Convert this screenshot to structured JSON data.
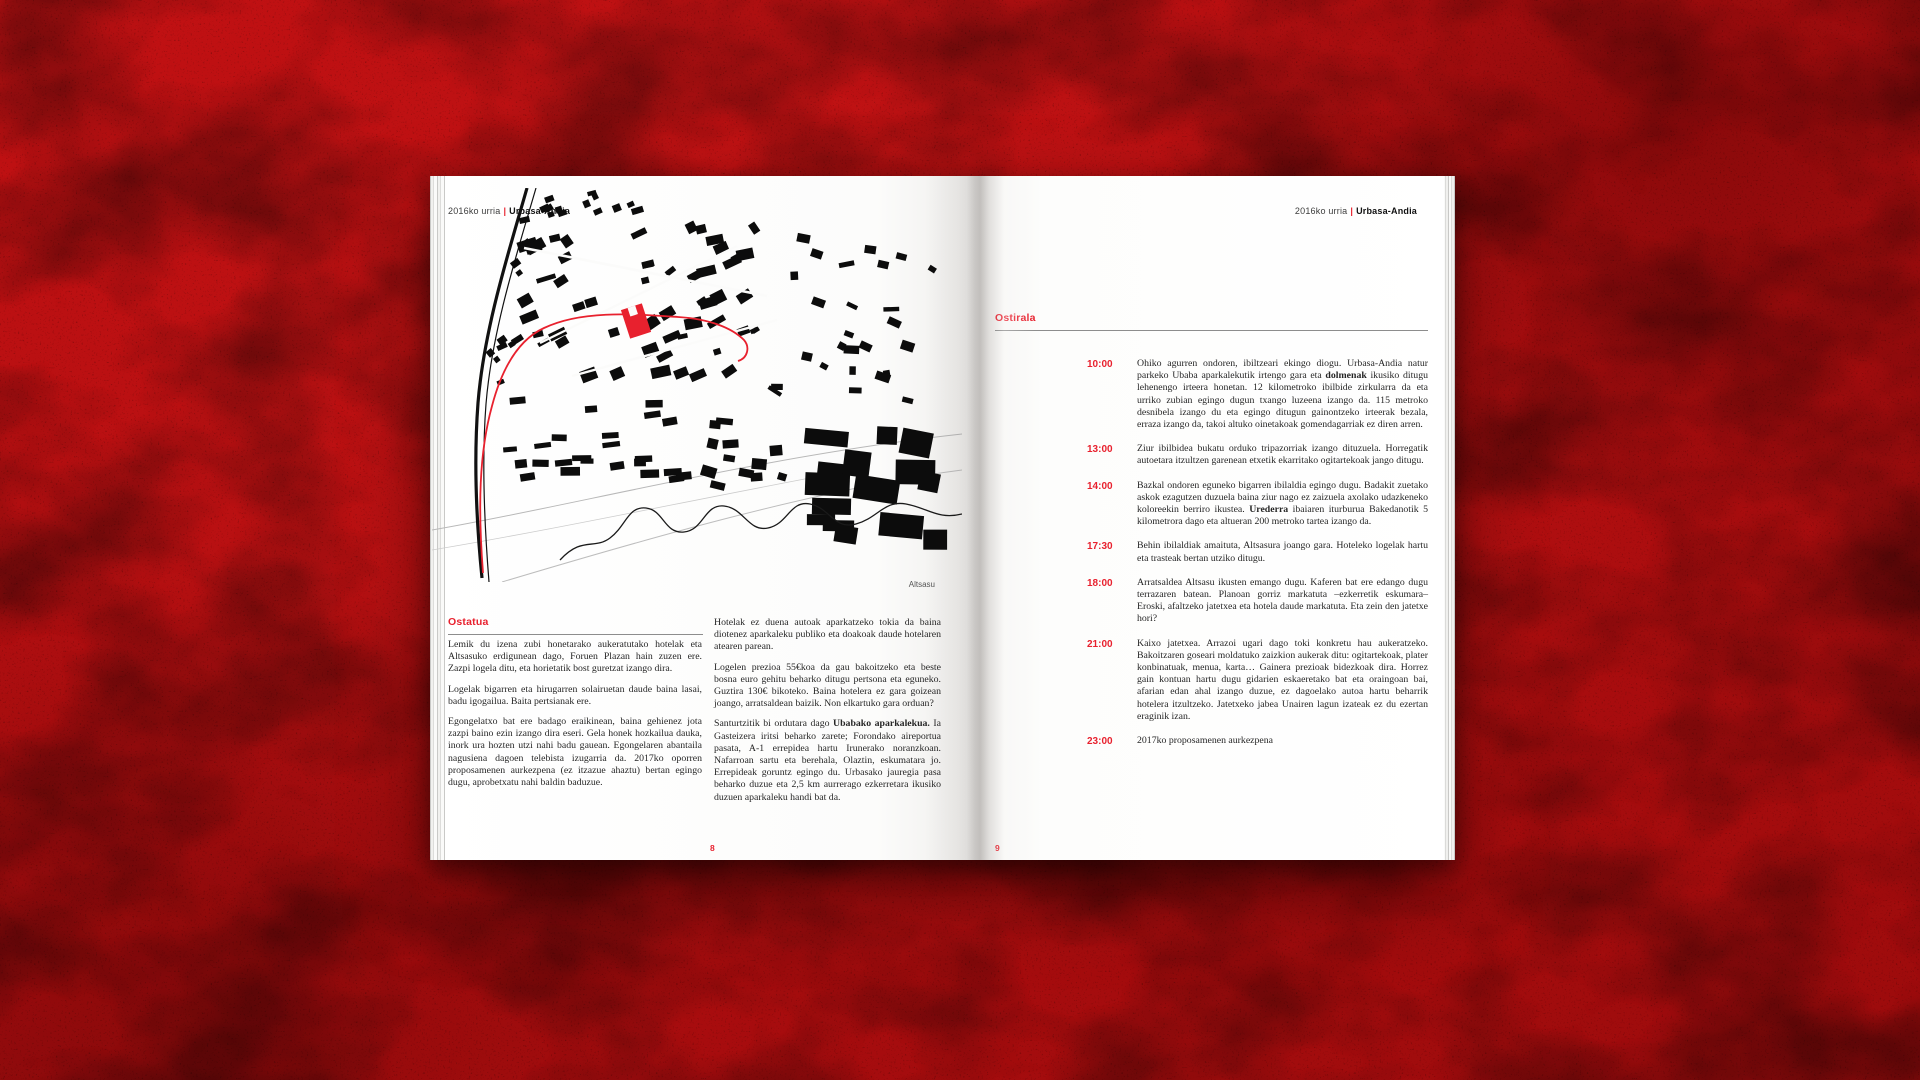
{
  "colors": {
    "accent_red": "#e8212e",
    "backdrop_red": "#b30e10",
    "map_black": "#0c0c0c",
    "rule_gray": "#8d8d8d"
  },
  "left": {
    "header": {
      "prefix": "2016ko urria",
      "separator": "|",
      "title": "Urbasa-Andia"
    },
    "map_caption": "Altsasu",
    "heading": "Ostatua",
    "col1": [
      "Lemik du izena zubi honetarako aukeratutako hotelak eta Altsasuko erdigunean dago, Foruen Plazan hain zuzen ere. Zazpi logela ditu, eta horietatik bost guretzat izango dira.",
      "Logelak bigarren eta hirugarren solairuetan daude baina lasai, badu igogailua. Baita pertsianak ere.",
      "Egongelatxo bat ere badago eraikinean, baina gehienez jota zazpi baino ezin izango dira eseri. Gela honek hozkailua dauka, inork ura hozten utzi nahi badu gauean. Egongelaren abantaila nagusiena dagoen telebista izugarria da. 2017ko oporren proposamenen aurkezpena (ez itzazue ahaztu) bertan egingo dugu, aprobetxatu nahi baldin baduzue."
    ],
    "col2": [
      "Hotelak ez duena autoak aparkatzeko tokia da baina diotenez aparkaleku publiko eta doakoak daude hotelaren atearen parean.",
      "Logelen prezioa 55€koa da gau bakoitzeko eta beste bosna euro gehitu beharko ditugu pertsona eta eguneko. Guztira 130€ bikoteko. Baina hotelera ez gara goizean joango, arratsaldean baizik. Non elkartuko gara orduan?",
      [
        {
          "t": "Santurtzitik bi ordutara dago "
        },
        {
          "t": "Ubabako aparkalekua.",
          "b": true
        },
        {
          "t": " Ia Gasteizera iritsi beharko zarete; Forondako aireportua pasata, A-1 errepidea hartu Irunerako noranzkoan. Nafarroan sartu eta berehala, Olaztin, eskumatara jo. Errepideak goruntz egingo du. Urbasako jauregia pasa beharko duzue eta 2,5 km aurrerago ezkerretara ikusiko duzuen aparkaleku handi bat da."
        }
      ]
    ],
    "page_number": "8"
  },
  "right": {
    "header": {
      "prefix": "2016ko urria",
      "separator": "|",
      "title": "Urbasa-Andia"
    },
    "heading": "Ostirala",
    "schedule": [
      {
        "time": "10:00",
        "segments": [
          {
            "t": "Ohiko agurren ondoren, ibiltzeari ekingo diogu. Urbasa-Andia natur parkeko Ubaba aparkalekutik irtengo gara eta "
          },
          {
            "t": "dolmenak",
            "b": true
          },
          {
            "t": " ikusiko ditugu lehenengo irteera honetan. 12 kilometroko ibilbide zirkularra da eta urriko zubian egingo dugun txango luzeena izango da. 115 metroko desnibela izango du eta egingo ditugun gainontzeko irteerak bezala, erraza izango da, takoi altuko oinetakoak gomendagarriak ez diren arren."
          }
        ]
      },
      {
        "time": "13:00",
        "segments": [
          {
            "t": "Ziur ibilbidea bukatu orduko tripazorriak izango dituzuela. Horregatik autoetara itzultzen garenean etxetik ekarritako ogitartekoak jango ditugu."
          }
        ]
      },
      {
        "time": "14:00",
        "segments": [
          {
            "t": "Bazkal ondoren eguneko bigarren ibilaldia egingo dugu. Badakit zuetako askok ezagutzen duzuela baina ziur nago ez zaizuela axolako udazkeneko koloreekin berriro ikustea. "
          },
          {
            "t": "Urederra",
            "b": true
          },
          {
            "t": " ibaiaren iturburua Bakedanotik 5 kilometrora dago eta altueran 200 metroko tartea izango da."
          }
        ]
      },
      {
        "time": "17:30",
        "segments": [
          {
            "t": "Behin ibilaldiak amaituta, Altsasura joango gara. Hoteleko logelak hartu eta trasteak bertan utziko ditugu."
          }
        ]
      },
      {
        "time": "18:00",
        "segments": [
          {
            "t": "Arratsaldea Altsasu ikusten emango dugu. Kaferen bat ere edango dugu terrazaren batean. Planoan gorriz markatuta –ezkerretik eskumara– Eroski, afaltzeko jatetxea eta hotela daude markatuta. Eta zein den jatetxe hori?"
          }
        ]
      },
      {
        "time": "21:00",
        "segments": [
          {
            "t": "Kaixo jatetxea. Arrazoi ugari dago toki konkretu hau aukeratzeko. Bakoitzaren goseari moldatuko zaizkion aukerak ditu: ogitartekoak, plater konbinatuak, menua, karta… Gainera prezioak bidezkoak dira. Horrez gain kontuan hartu dugu gidarien eskaeretako bat eta oraingoan bai, afarian edan ahal izango duzue, ez dagoelako autoa hartu beharrik hotelera itzultzeko. Jatetxeko jabea Unairen lagun izateak ez du ezertan eraginik izan."
          }
        ]
      },
      {
        "time": "23:00",
        "segments": [
          {
            "t": "2017ko proposamenen aurkezpena"
          }
        ]
      }
    ],
    "page_number": "9"
  }
}
